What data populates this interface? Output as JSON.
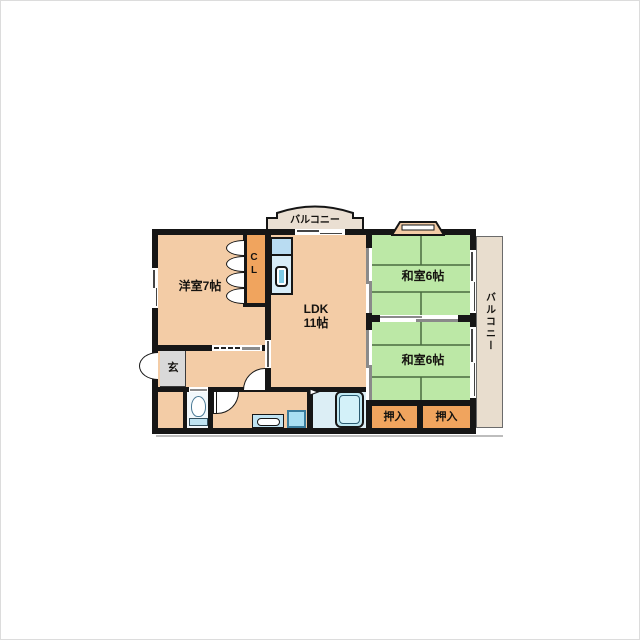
{
  "plan_type": "apartment-floor-plan",
  "rooms": {
    "western": {
      "label": "洋室7帖"
    },
    "ldk": {
      "name": "LDK",
      "size": "11帖"
    },
    "japanese_top": {
      "label": "和室6帖"
    },
    "japanese_bottom": {
      "label": "和室6帖"
    },
    "closet": {
      "letter_top": "C",
      "letter_bottom": "L"
    },
    "entrance": {
      "label": "玄"
    },
    "oshiire_left": {
      "label": "押入"
    },
    "oshiire_right": {
      "label": "押入"
    }
  },
  "balconies": {
    "top": {
      "label": "バルコニー"
    },
    "right": {
      "label": "バルコニー"
    }
  },
  "colors": {
    "wall": "#161616",
    "floor_tan": "#F3CCA6",
    "tatami_green": "#BCE8A6",
    "closet_orange": "#F0A45E",
    "balcony_beige": "#E8DDCE",
    "entrance_gray": "#D9D9D9",
    "water_blue": "#BFE3F2",
    "bath_floor": "#DCEEF5"
  }
}
